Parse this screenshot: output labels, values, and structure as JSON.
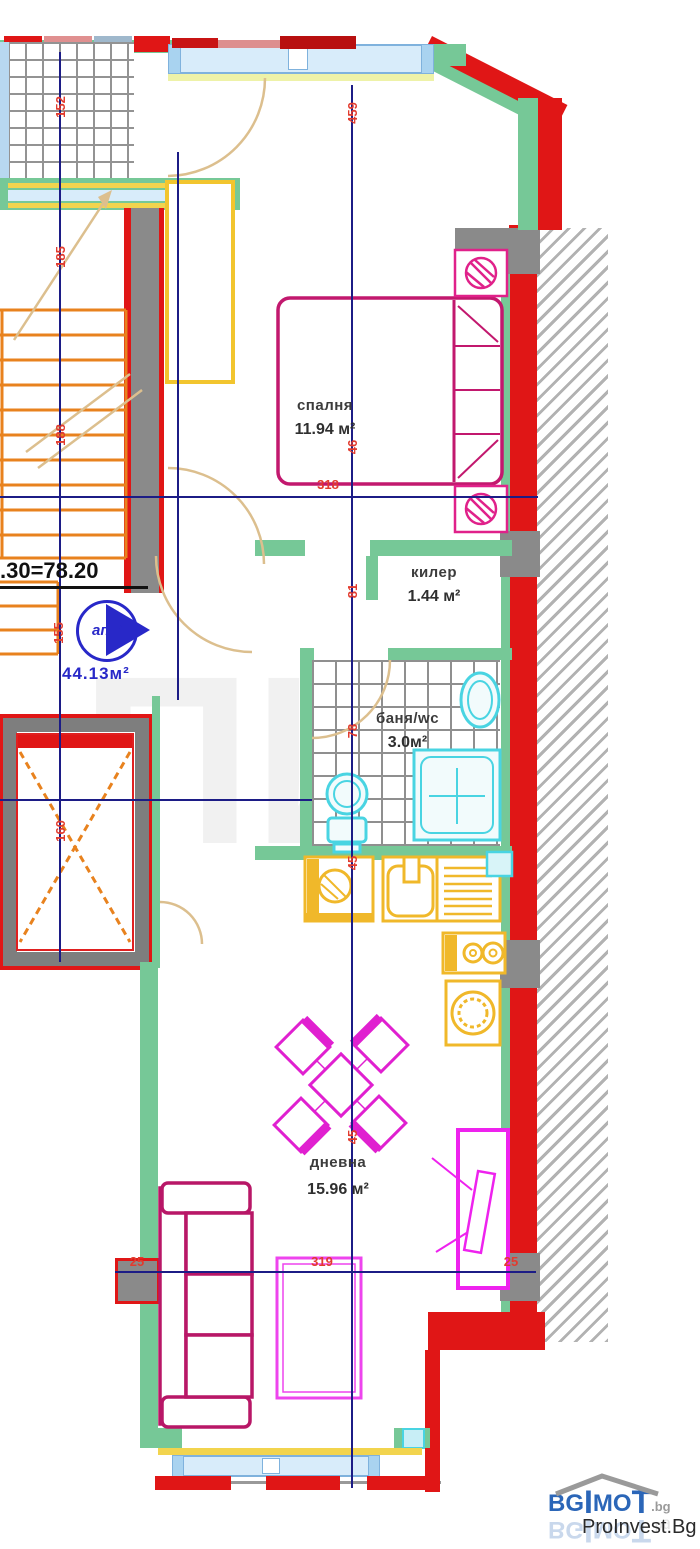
{
  "plan": {
    "rooms": [
      {
        "name": "спалня",
        "area": "11.94 м²"
      },
      {
        "name": "килер",
        "area": "1.44 м²"
      },
      {
        "name": "баня/wc",
        "area": "3.0м²"
      },
      {
        "name": "дневна",
        "area": "15.96 м²"
      }
    ],
    "apartment": {
      "formula": ".30=78.20",
      "unit_badge": "ап.3",
      "unit_area": "44.13м²"
    },
    "dimensions": [
      "318",
      "319",
      "25",
      "25",
      "459",
      "46",
      "81",
      "78",
      "45",
      "45",
      "185",
      "188",
      "155",
      "160",
      "152"
    ],
    "watermark": "ПИ"
  },
  "branding": {
    "logo": {
      "bg": "BG",
      "pillar1": "I",
      "mo": "MO",
      "pillar2": "T",
      "suffix": ".bg"
    },
    "company": "ProInvest.Bg"
  },
  "colors": {
    "wall_green": "#76c897",
    "wall_red": "#e01616",
    "column_gray": "#8a8a8a",
    "window_blue": "#a9d3f0",
    "furniture_magenta": "#e020d0",
    "furniture_crimson": "#c2186e",
    "fixture_cyan": "#49d4e2",
    "kitchen_yellow": "#f0b82a",
    "stairs_orange": "#e8821e",
    "axis_navy": "#1c1c86",
    "dimension_red": "#e23b2e",
    "logo_blue": "#2b66b8"
  }
}
